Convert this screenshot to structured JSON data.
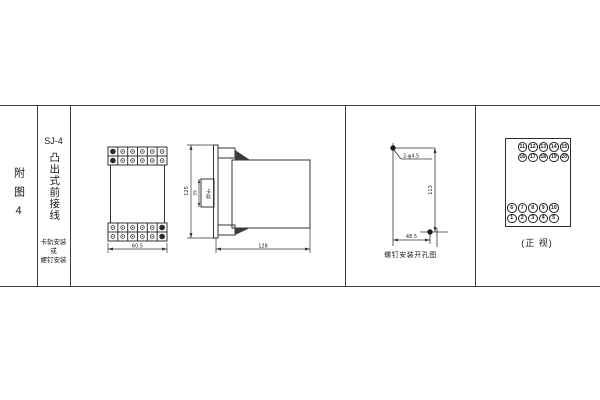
{
  "figure": {
    "row_label": "附图4",
    "model": "SJ-4",
    "type_label": "凸出式前接线",
    "mount_note": [
      "卡轨安装",
      "或",
      "螺钉安装"
    ]
  },
  "front_view": {
    "width_dim": "60.5"
  },
  "side_view": {
    "height_dim": "125",
    "rail_dim": "35",
    "rail_label": "卡轨",
    "depth_dim": "128"
  },
  "drill_view": {
    "holes_label": "2-φ4.5",
    "vertical_dim": "113",
    "horizontal_dim": "48.5",
    "caption": "螺钉安装开孔图"
  },
  "terminal_view": {
    "caption": "(正 视)",
    "top_rows": [
      [
        "11",
        "12",
        "13",
        "14",
        "15"
      ],
      [
        "16",
        "17",
        "18",
        "19",
        "20"
      ]
    ],
    "bottom_rows": [
      [
        "6",
        "7",
        "8",
        "9",
        "10"
      ],
      [
        "1",
        "2",
        "3",
        "4",
        "5"
      ]
    ]
  }
}
